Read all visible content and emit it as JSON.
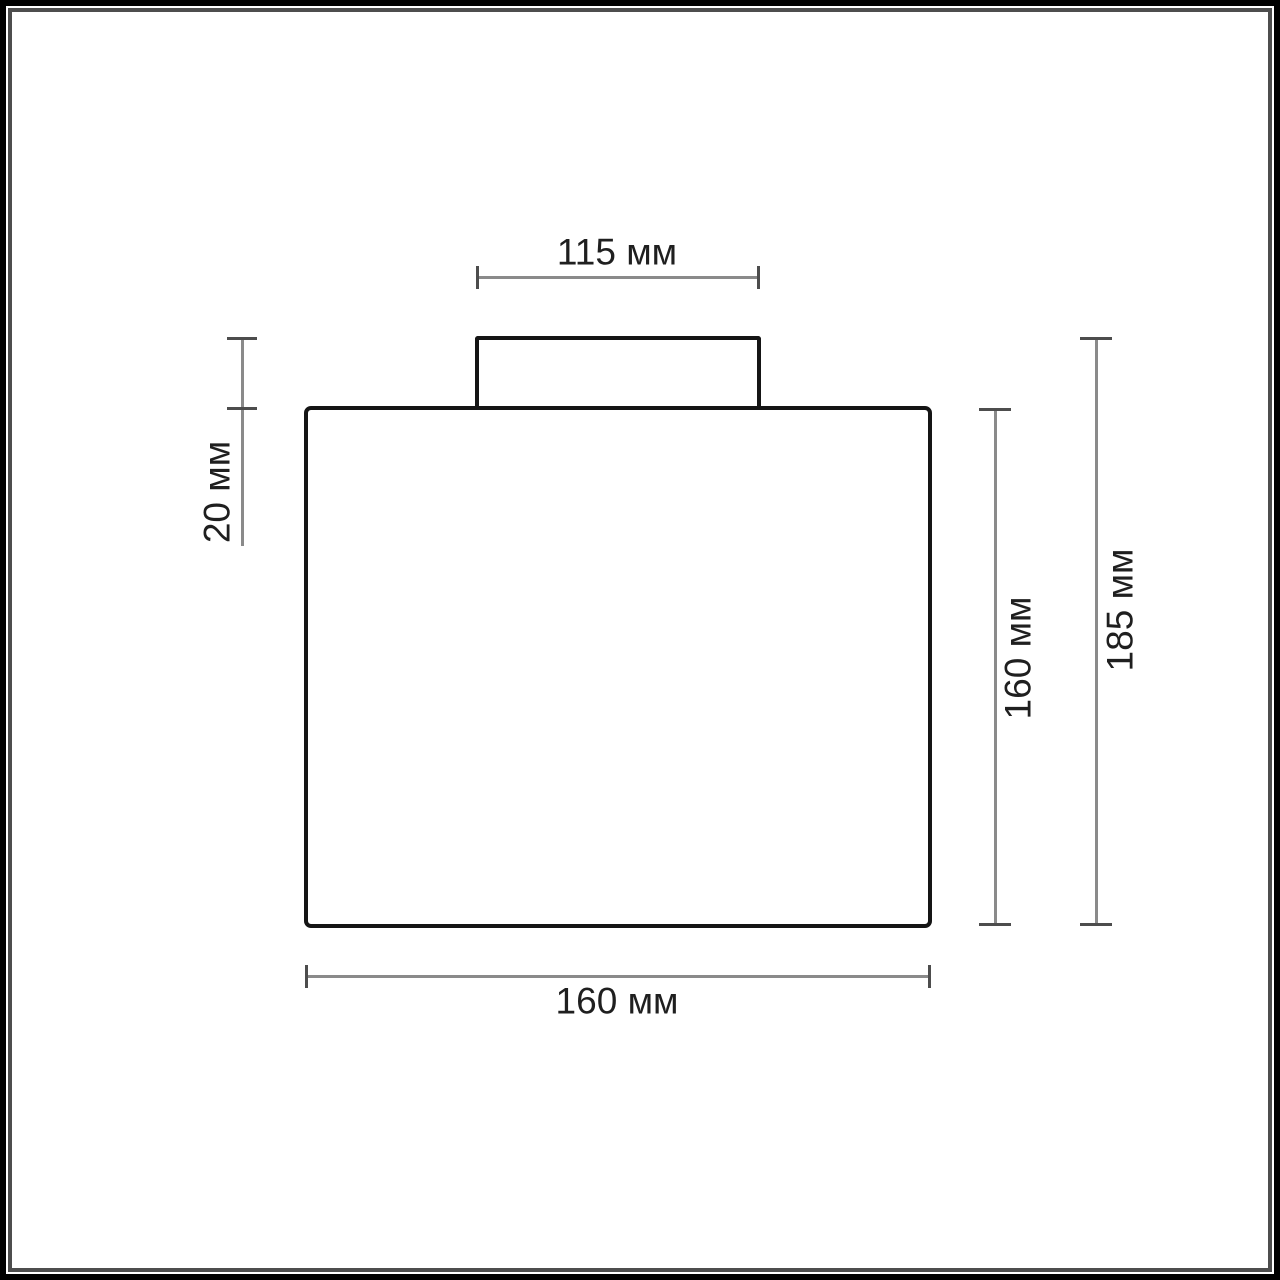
{
  "canvas": {
    "background": "#ffffff",
    "frame_outer_color": "#000000",
    "frame_inner_color": "#4d4d4d"
  },
  "drawing": {
    "type": "technical-dimension-diagram",
    "outline_color": "#151515",
    "dimension_line_color": "#8a8a8a",
    "tick_color": "#4d4d4d",
    "label_color": "#1f1f1f",
    "unit": "мм",
    "dimensions": {
      "mount_width": {
        "label": "115 мм",
        "value": 115,
        "unit": "мм",
        "orientation": "horizontal-top"
      },
      "mount_height": {
        "label": "20 мм",
        "value": 20,
        "unit": "мм",
        "orientation": "vertical-left"
      },
      "body_height": {
        "label": "160 мм",
        "value": 160,
        "unit": "мм",
        "orientation": "vertical-right-inner"
      },
      "total_height": {
        "label": "185 мм",
        "value": 185,
        "unit": "мм",
        "orientation": "vertical-right-outer"
      },
      "body_width": {
        "label": "160 мм",
        "value": 160,
        "unit": "мм",
        "orientation": "horizontal-bottom"
      }
    }
  }
}
